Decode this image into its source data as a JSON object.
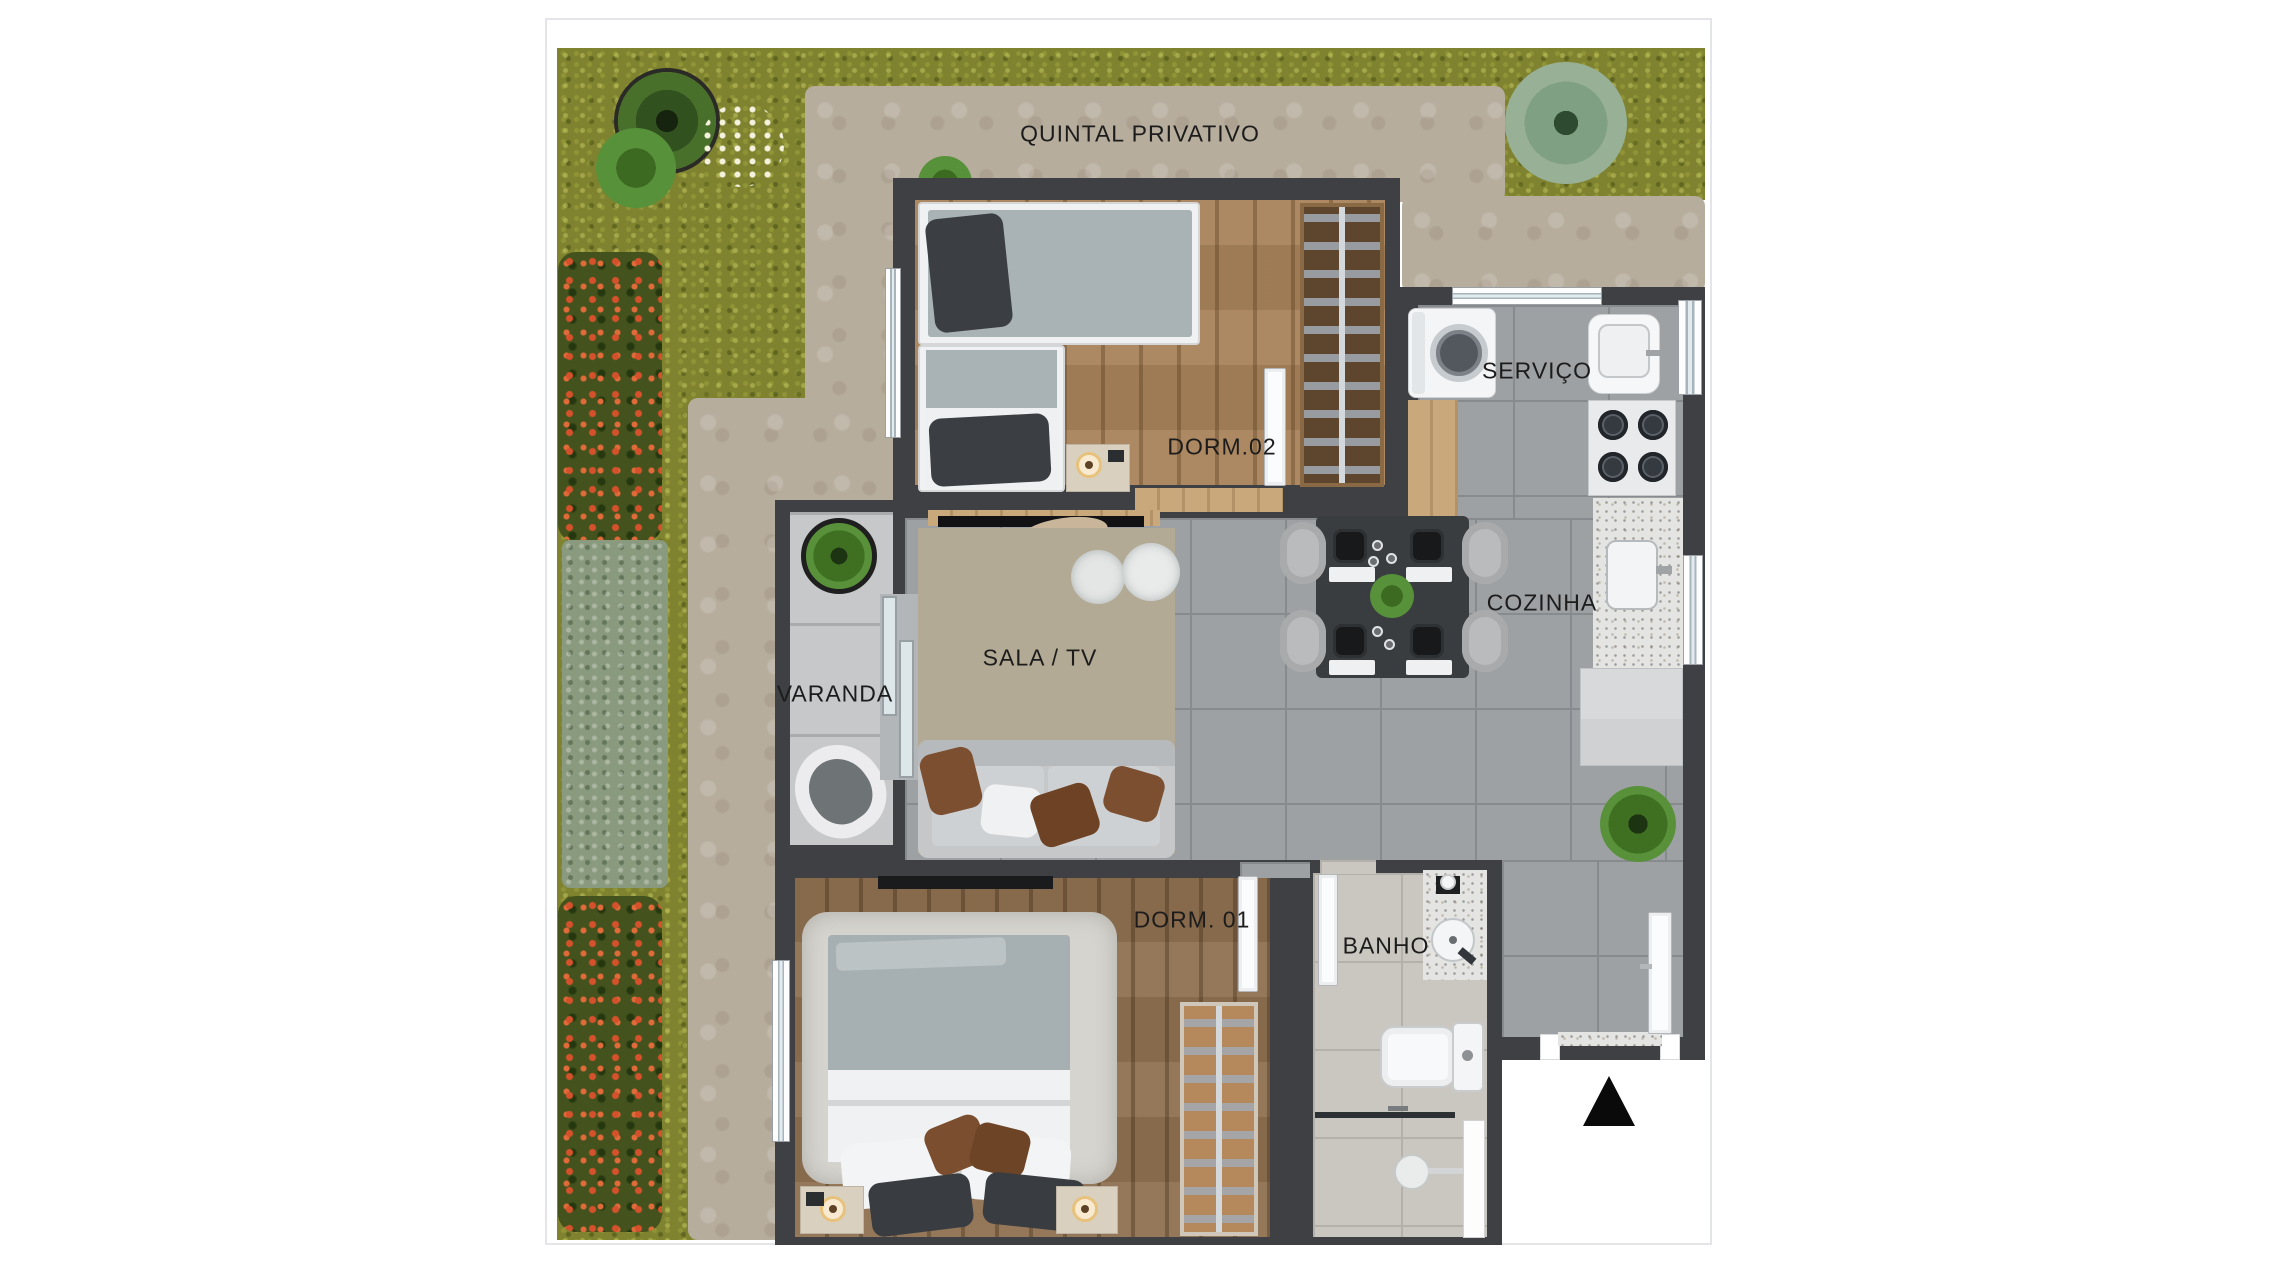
{
  "plan": {
    "type": "residential-floor-plan-top-view",
    "labels": {
      "quintal": "QUINTAL PRIVATIVO",
      "dorm02": "DORM.02",
      "servico": "SERVIÇO",
      "cozinha": "COZINHA",
      "sala": "SALA / TV",
      "varanda": "VARANDA",
      "dorm01": "DORM. 01",
      "banho": "BANHO"
    },
    "rooms": [
      {
        "id": "quintal",
        "label": "QUINTAL PRIVATIVO"
      },
      {
        "id": "dorm02",
        "label": "DORM.02"
      },
      {
        "id": "servico",
        "label": "SERVIÇO"
      },
      {
        "id": "cozinha",
        "label": "COZINHA"
      },
      {
        "id": "sala",
        "label": "SALA / TV"
      },
      {
        "id": "varanda",
        "label": "VARANDA"
      },
      {
        "id": "dorm01",
        "label": "DORM. 01"
      },
      {
        "id": "banho",
        "label": "BANHO"
      }
    ],
    "icons": {
      "entry_marker": "entry-triangle-marker"
    },
    "colors": {
      "grass": "#7f822f",
      "path": "#b7ad9d",
      "wall": "#3f4043",
      "tile_floor": "#9ea1a4",
      "wood_floor_dorm02": "#a8835a",
      "wood_floor_dorm01": "#8f7050",
      "varanda_floor": "#c6c8ca",
      "banho_floor": "#cac6c0",
      "rug_sala": "#b3aa95",
      "flowers": "#d4512b",
      "hedge": "#8a9a7e",
      "entry_marker": "#0a0a0a"
    }
  }
}
